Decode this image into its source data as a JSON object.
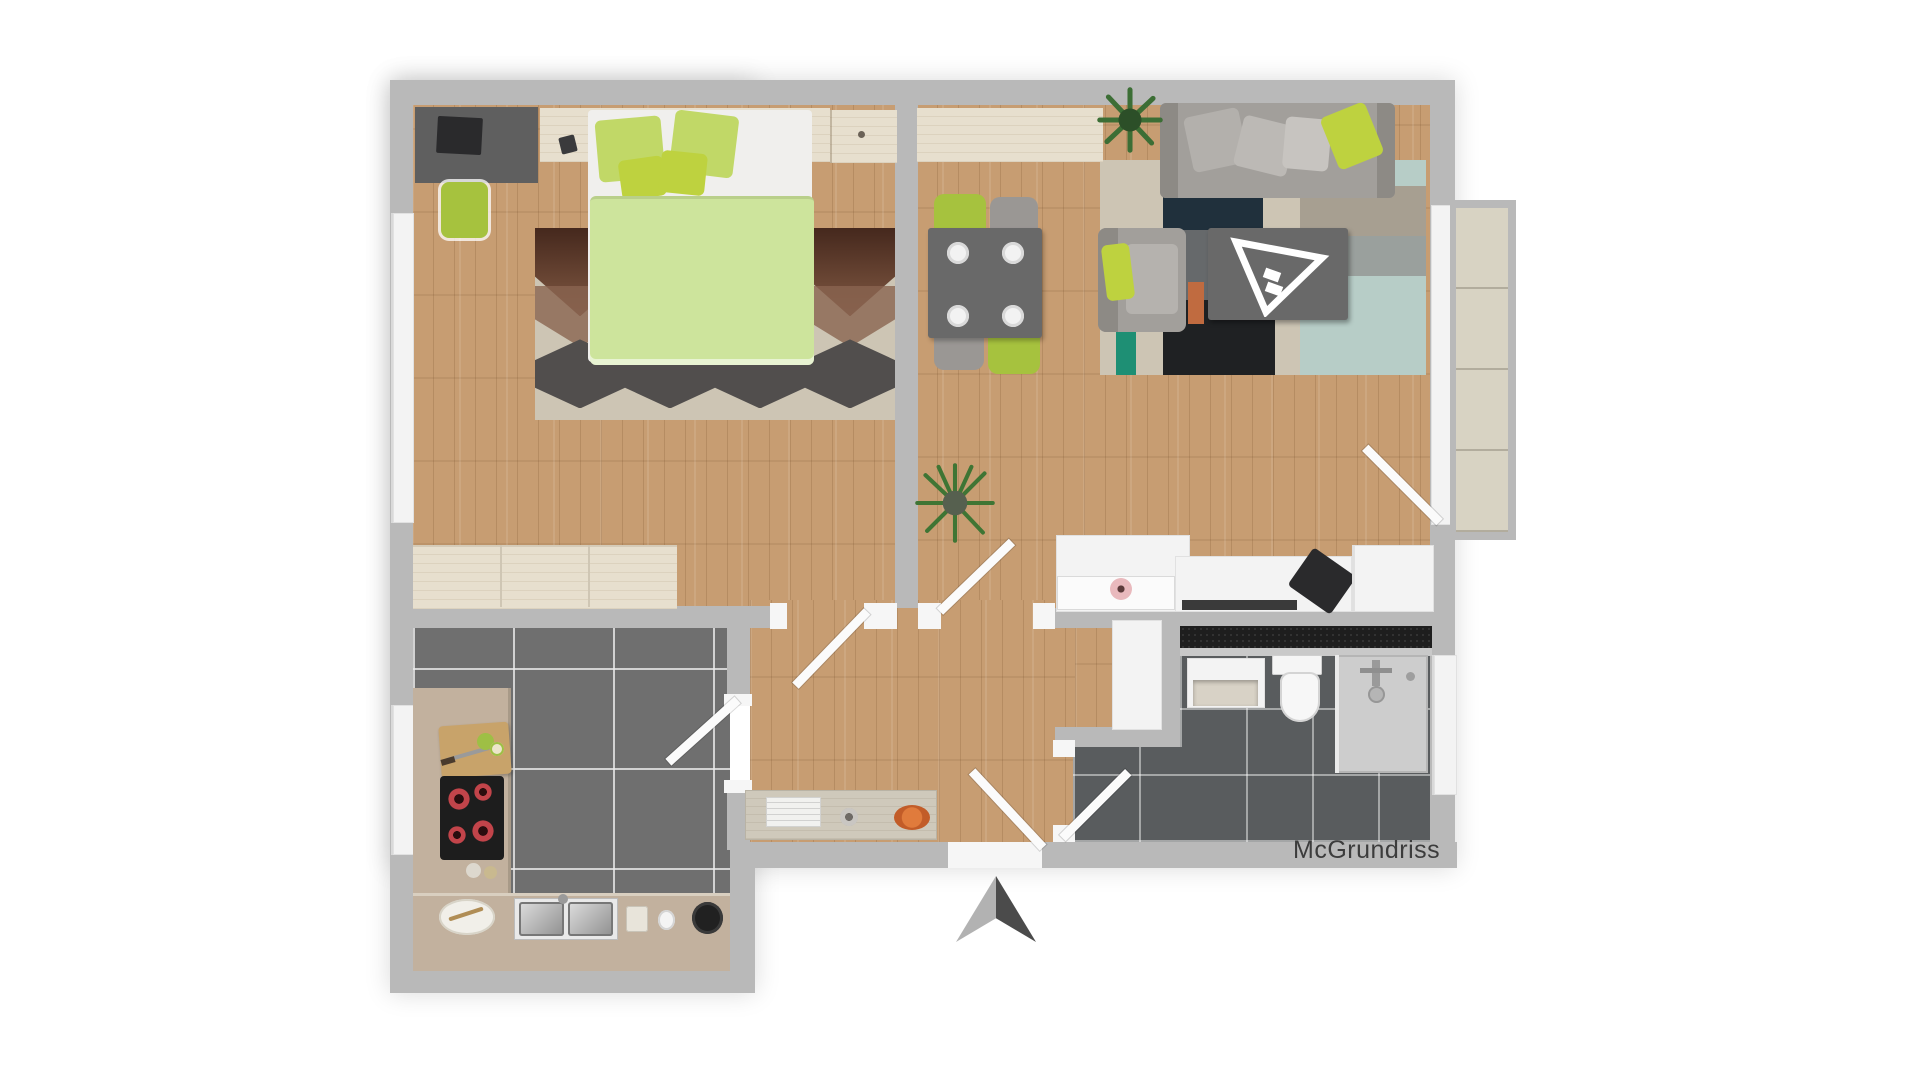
{
  "watermark": {
    "text": "McGrundriss"
  },
  "colors": {
    "wall": "#b9b9b9",
    "wood_floor": "#c79d72",
    "light_wood": "#e7dfce",
    "kitchen_tile": "#6f6f6f",
    "bath_tile": "#595c5e",
    "balcony_tile": "#d8d3c3",
    "duvet": "#cde49c",
    "pillow_lime": "#c1d867",
    "cushion_bright": "#bed23f",
    "rug_brown_dark": "#45281d",
    "rug_brown": "#8a6450",
    "rug_beige": "#cdc5b4",
    "rug_charcoal": "#514e4d",
    "sofa_gray": "#a29f9b",
    "armrest_gray": "#8d8a85",
    "table_gray": "#696969",
    "chair_lime": "#a6c23e",
    "chair_gray": "#9a9794",
    "patch_navy": "#20303c",
    "patch_black": "#1f2123",
    "patch_mint": "#b7cdc7",
    "patch_gray": "#a79f91",
    "patch_orange": "#c06b40",
    "patch_teal": "#1e8f74",
    "counter_wood": "#c2b19e",
    "cooktop": "#1d1d1d",
    "bath_counter": "#1e1e1e",
    "shower": "#cdcdcd",
    "white_furn": "#f3f3f3",
    "desk_dark": "#5f5f5f",
    "laptop_black": "#2a2a2c",
    "arrow_light": "#b2b2b2",
    "arrow_dark": "#4b4b4b",
    "plant_green": "#3c6e35",
    "text": "#3c3c3c"
  }
}
